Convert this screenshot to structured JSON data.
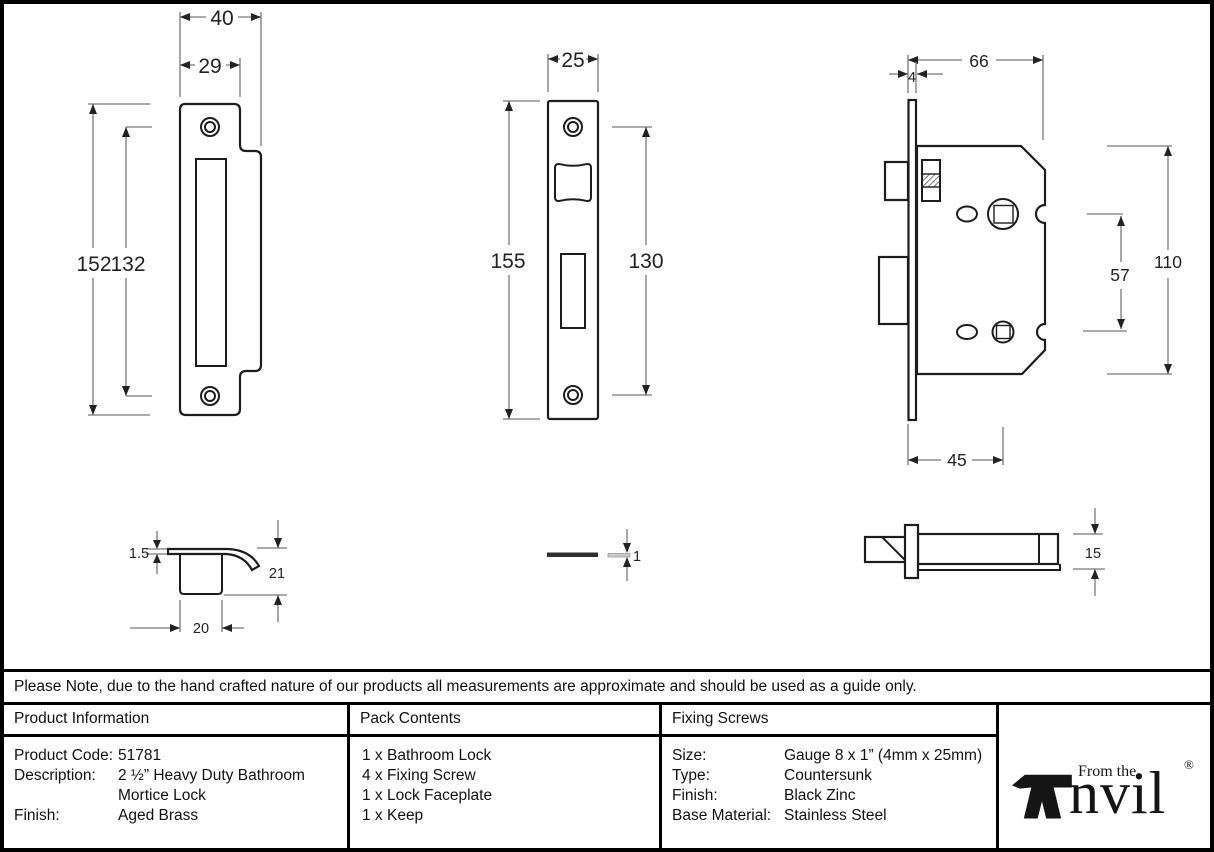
{
  "note": "Please Note, due to the hand crafted nature of our products all measurements are approximate and should be used as a guide only.",
  "dims": {
    "keep_front": {
      "outer_width": "40",
      "inner_width": "29",
      "overall_height": "152",
      "hole_spacing": "132"
    },
    "faceplate_front": {
      "width": "25",
      "overall_height": "155",
      "hole_spacing": "130"
    },
    "lock_body": {
      "depth": "66",
      "plate_thickness": "4",
      "overall_height": "110",
      "follower_spacing": "57",
      "backset": "45"
    },
    "keep_side": {
      "plate_thickness": "1.5",
      "depth": "21",
      "width": "20"
    },
    "faceplate_side": {
      "thickness": "1"
    },
    "bolt_side": {
      "height": "15"
    }
  },
  "table": {
    "product_info": {
      "header": "Product Information",
      "rows": [
        {
          "label": "Product Code:",
          "value": "51781"
        },
        {
          "label": "Description:",
          "value": "2 ½” Heavy Duty Bathroom Mortice Lock"
        },
        {
          "label": "Finish:",
          "value": "Aged Brass"
        }
      ]
    },
    "pack_contents": {
      "header": "Pack Contents",
      "items": [
        "1 x Bathroom Lock",
        "4 x Fixing Screw",
        "1 x Lock Faceplate",
        "1 x Keep"
      ]
    },
    "fixing_screws": {
      "header": "Fixing Screws",
      "rows": [
        {
          "label": "Size:",
          "value": "Gauge 8 x 1” (4mm x 25mm)"
        },
        {
          "label": "Type:",
          "value": "Countersunk"
        },
        {
          "label": "Finish:",
          "value": "Black Zinc"
        },
        {
          "label": "Base Material:",
          "value": "Stainless Steel"
        }
      ]
    }
  },
  "logo": {
    "small_text": "From the",
    "brand": "nvil",
    "registered": "®"
  },
  "colors": {
    "line": "#1d1d1d",
    "dimension": "#787878",
    "text": "#111111"
  }
}
